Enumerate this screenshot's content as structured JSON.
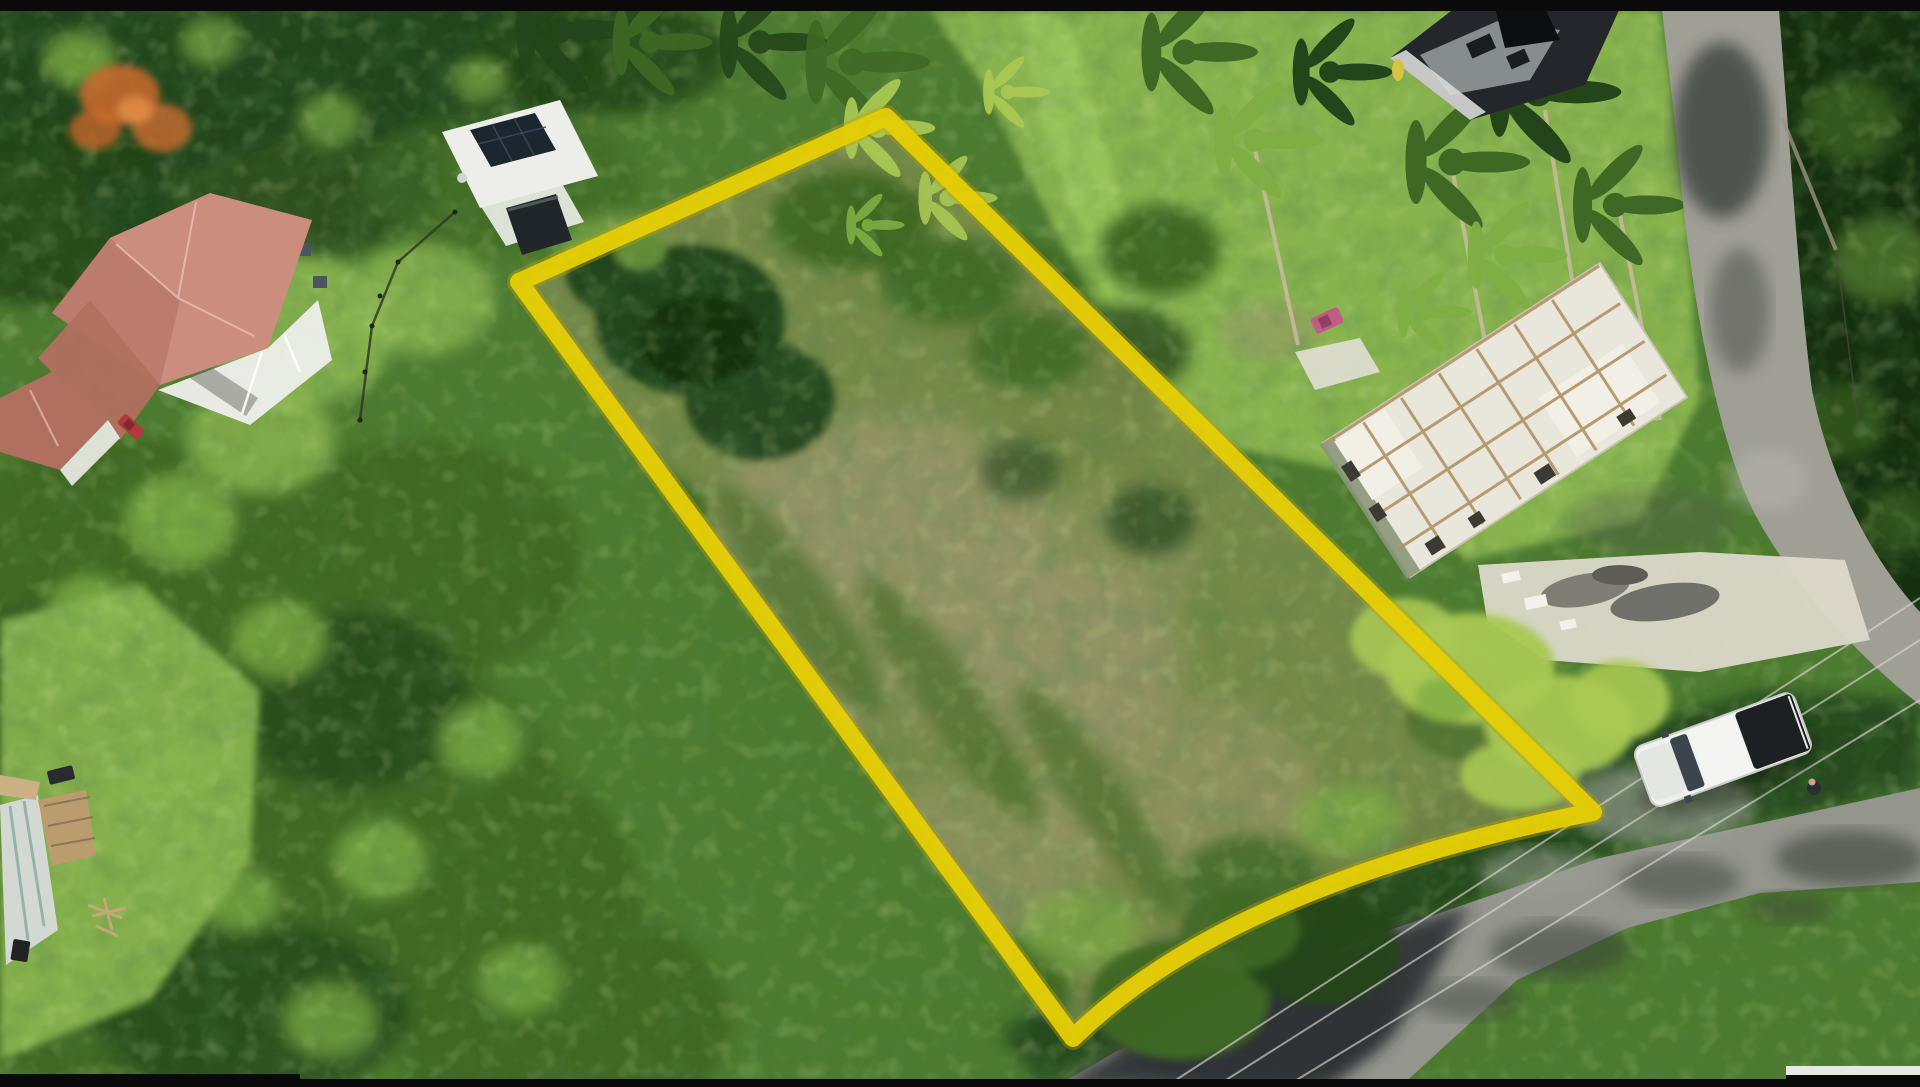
{
  "scene": {
    "type": "aerial-drone-photo",
    "description": "Aerial drone photograph of a vacant overgrown land parcel outlined with a thick yellow boundary, surrounded by tropical forest, a red-roofed house with veranda, a small white house with rooftop solar panels, two unfinished concrete buildings under construction, coconut palms, a gravel side road, a paved asphalt road with overhead power cables, a white pickup truck parked on the road, and a mowed green field, with thin black letterbox bars at the top and bottom edges",
    "annotations": {
      "property_boundary": {
        "shape": "quadrilateral",
        "color": "#e6cf06",
        "vertices": [
          [
            519,
            282
          ],
          [
            886,
            117
          ],
          [
            1593,
            812
          ],
          [
            1073,
            1038
          ]
        ]
      }
    },
    "objects": [
      {
        "name": "red-roof-house",
        "desc": "two-storey house with salmon hipped roof, white walls and veranda",
        "area": [
          50,
          180,
          330,
          430
        ]
      },
      {
        "name": "small-red-roof-cottage",
        "desc": "smaller salmon-roofed outbuilding at left edge",
        "area": [
          0,
          370,
          120,
          485
        ]
      },
      {
        "name": "red-car",
        "desc": "small red car parked by cottage",
        "area": [
          118,
          418,
          146,
          434
        ]
      },
      {
        "name": "solar-house",
        "desc": "white flat-roof house with dark rooftop solar array",
        "area": [
          438,
          98,
          598,
          210
        ]
      },
      {
        "name": "dark-shed",
        "desc": "dark gazebo/shed behind solar house",
        "area": [
          506,
          194,
          572,
          255
        ]
      },
      {
        "name": "flowering-tree",
        "desc": "orange flamboyant tree crown",
        "area": [
          80,
          70,
          195,
          155
        ]
      },
      {
        "name": "vacant-lot",
        "desc": "scrubby overgrown parcel inside yellow boundary"
      },
      {
        "name": "dark-construction-building",
        "desc": "dark unfinished building at top right",
        "area": [
          1390,
          8,
          1620,
          120
        ]
      },
      {
        "name": "white-construction-building",
        "desc": "large unfinished two-storey concrete house with timber formwork",
        "area": [
          1330,
          300,
          1700,
          540
        ]
      },
      {
        "name": "pink-car",
        "desc": "small pink vehicle beside construction site",
        "area": [
          1312,
          310,
          1345,
          332
        ]
      },
      {
        "name": "gravel-road",
        "desc": "light gray side road running from top edge and curving right"
      },
      {
        "name": "asphalt-road",
        "desc": "paved road crossing bottom right, shaded at left, sunlit at right"
      },
      {
        "name": "power-cables",
        "desc": "three overhead utility cables running along the asphalt road"
      },
      {
        "name": "white-pickup-truck",
        "desc": "white double-cab pickup with dark bed cover parked on road",
        "area": [
          1638,
          700,
          1815,
          805
        ]
      },
      {
        "name": "green-field",
        "desc": "mowed grass field at bottom right corner"
      },
      {
        "name": "marl-ground",
        "desc": "white marl ground with gray rubble piles near construction"
      },
      {
        "name": "sea-grape-bushes",
        "desc": "bright yellow-green bush mass left of the truck"
      },
      {
        "name": "neighbor-roof",
        "desc": "corrugated roof, wooden deck, boat and debris at bottom left edge"
      },
      {
        "name": "letterbox-bars",
        "desc": "thin black bars at top and bottom of frame"
      }
    ]
  },
  "palette": {
    "black_bar": "#0a0a0a",
    "veg_base": "#4d7a2f",
    "veg_mid": "#3f6824",
    "veg_dark": "#24451a",
    "veg_deep": "#16300f",
    "veg_light": "#7fae44",
    "veg_lime": "#a9c853",
    "lawn": "#8db851",
    "lawn_bright": "#9cc75d",
    "scrub_olive": "#7c8c4c",
    "scrub_dry": "#98966a",
    "boundary_yellow": "#e6cf06",
    "boundary_edge": "#b89f06",
    "road_gravel": "#a09f96",
    "asphalt_light": "#94968e",
    "asphalt_dark": "#2f3335",
    "roof_salmon": "#cb8d7e",
    "roof_salmon_dark": "#b1705f",
    "wall_white": "#edeeea",
    "building_white": "#e9e6dc",
    "wood_tan": "#b09364",
    "panel_dark": "#1c2631",
    "truck_white": "#eff1ee",
    "truck_bed": "#1d2023",
    "flower_orange": "#cc6a2e",
    "marl_white": "#dcd9ca",
    "rubble_gray": "#7e7e74",
    "car_red": "#b03a3c",
    "car_pink": "#c25c86",
    "cable_light": "#d6d7d0",
    "teal_roof": "#86aaa1",
    "shadow": "#1b2b12"
  }
}
